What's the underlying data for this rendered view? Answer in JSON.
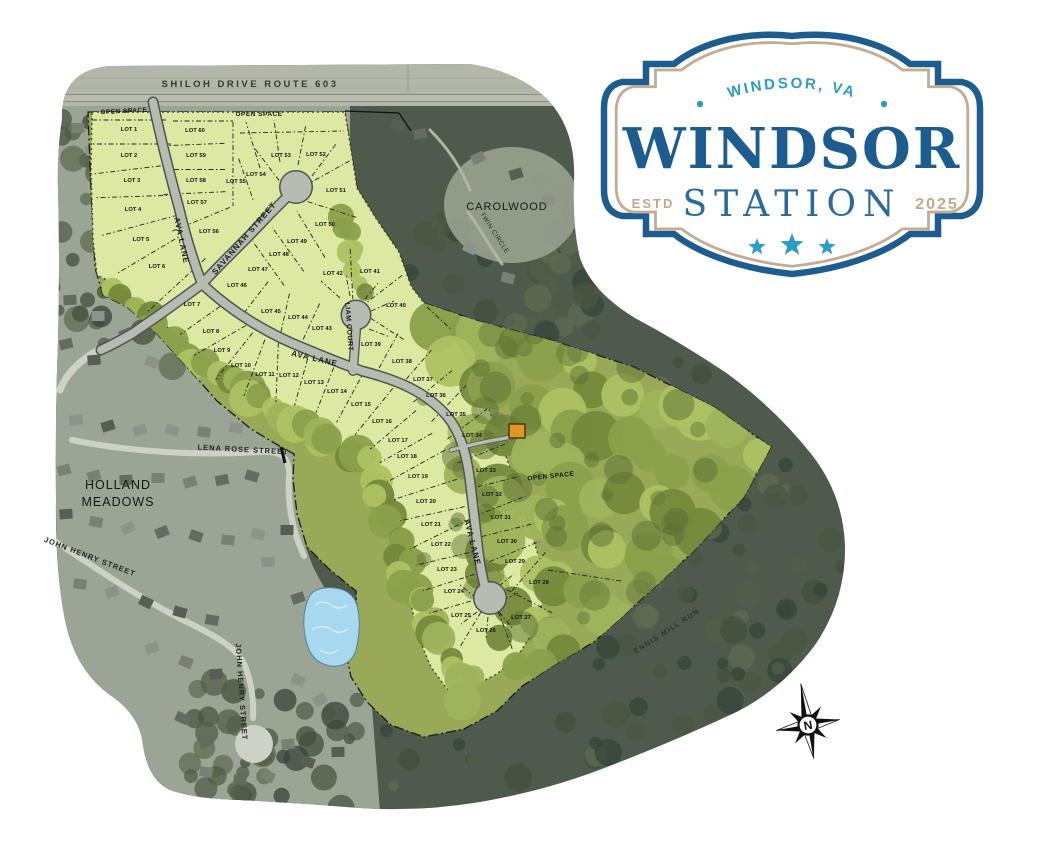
{
  "page": {
    "background": "#ffffff"
  },
  "logo": {
    "arc_text": "WINDSOR, VA",
    "name": "WINDSOR",
    "subname": "STATION",
    "estd": "ESTD",
    "year": "2025",
    "stars": 3,
    "colors": {
      "dark_blue": "#1d5c8e",
      "light_blue": "#2e9bc5",
      "mid_blue": "#2a6b9c",
      "tan": "#c3ac92"
    }
  },
  "compass": {
    "label": "N"
  },
  "map": {
    "lot_prefix": "LOT",
    "colors": {
      "plat_yellow": "#dde8a2",
      "plat_olive": "#99a957",
      "forest": "#4e5a4b",
      "pond": "#a8d8f0",
      "marker_orange": "#dd9722",
      "road_gray": "#b8bbb2"
    },
    "streets": [
      {
        "name": "SHILOH DRIVE ROUTE 603",
        "x": 250,
        "y": 87,
        "rotate": 0,
        "size": 9.5,
        "spacing": 2.5,
        "bold": true,
        "color": "#343931"
      },
      {
        "name": "AVA LANE",
        "x": 179,
        "y": 241,
        "rotate": 78,
        "size": 8,
        "spacing": 1,
        "bold": true,
        "color": "#1c1c1c"
      },
      {
        "name": "SAVANNAH STREET",
        "x": 246,
        "y": 240,
        "rotate": -49,
        "size": 8,
        "spacing": 1,
        "bold": true,
        "color": "#1c1c1c"
      },
      {
        "name": "AVA LANE",
        "x": 314,
        "y": 361,
        "rotate": 13,
        "size": 8,
        "spacing": 1,
        "bold": true,
        "color": "#1c1c1c"
      },
      {
        "name": "LIAM COURT",
        "x": 347,
        "y": 327,
        "rotate": 86,
        "size": 7,
        "spacing": 0.5,
        "bold": true,
        "color": "#1c1c1c"
      },
      {
        "name": "AVA LANE",
        "x": 470,
        "y": 543,
        "rotate": 76,
        "size": 8,
        "spacing": 1,
        "bold": true,
        "color": "#1c1c1c"
      },
      {
        "name": "LENA ROSE STREET",
        "x": 243,
        "y": 452,
        "rotate": 3,
        "size": 7.5,
        "spacing": 1,
        "bold": true,
        "color": "#23261f"
      },
      {
        "name": "JOHN HENRY STREET",
        "x": 89,
        "y": 559,
        "rotate": 21,
        "size": 7.5,
        "spacing": 1,
        "bold": true,
        "color": "#23261f"
      },
      {
        "name": "JOHN HENRY STREET",
        "x": 239,
        "y": 692,
        "rotate": 86,
        "size": 7.5,
        "spacing": 1,
        "bold": true,
        "color": "#23261f"
      },
      {
        "name": "TWIN CIRCLE",
        "x": 493,
        "y": 234,
        "rotate": 57,
        "size": 6.5,
        "spacing": 0.5,
        "bold": false,
        "color": "#2a2d27"
      },
      {
        "name": "ENNIS MILL RUN",
        "x": 668,
        "y": 633,
        "rotate": -33,
        "size": 7,
        "spacing": 1.5,
        "bold": false,
        "color": "#20241f"
      }
    ],
    "areas": [
      {
        "name": "OPEN SPACE",
        "x": 124,
        "y": 113,
        "rotate": -3,
        "size": 6.5,
        "spacing": 0.5,
        "bold": true,
        "color": "#161616"
      },
      {
        "name": "OPEN SPACE",
        "x": 259,
        "y": 116,
        "rotate": 0,
        "size": 6.5,
        "spacing": 0.5,
        "bold": true,
        "color": "#161616"
      },
      {
        "name": "OPEN SPACE",
        "x": 551,
        "y": 478,
        "rotate": -6,
        "size": 6.5,
        "spacing": 0.5,
        "bold": true,
        "color": "#161616"
      },
      {
        "name": "CAROLWOOD",
        "x": 507,
        "y": 210,
        "rotate": 0,
        "size": 11,
        "spacing": 1,
        "bold": false,
        "color": "#181b17"
      },
      {
        "name": "HOLLAND",
        "x": 118,
        "y": 489,
        "rotate": 0,
        "size": 12.5,
        "spacing": 1,
        "bold": false,
        "color": "#141613"
      },
      {
        "name": "MEADOWS",
        "x": 118,
        "y": 506,
        "rotate": 0,
        "size": 12.5,
        "spacing": 1,
        "bold": false,
        "color": "#141613"
      }
    ],
    "lots": [
      {
        "n": 1,
        "x": 129,
        "y": 131
      },
      {
        "n": 2,
        "x": 129,
        "y": 157
      },
      {
        "n": 3,
        "x": 132,
        "y": 182
      },
      {
        "n": 4,
        "x": 133,
        "y": 211
      },
      {
        "n": 5,
        "x": 141,
        "y": 241
      },
      {
        "n": 6,
        "x": 157,
        "y": 268
      },
      {
        "n": 7,
        "x": 192,
        "y": 306
      },
      {
        "n": 8,
        "x": 211,
        "y": 333
      },
      {
        "n": 9,
        "x": 222,
        "y": 352
      },
      {
        "n": 10,
        "x": 241,
        "y": 367
      },
      {
        "n": 11,
        "x": 265,
        "y": 376
      },
      {
        "n": 12,
        "x": 289,
        "y": 377
      },
      {
        "n": 13,
        "x": 314,
        "y": 384
      },
      {
        "n": 14,
        "x": 337,
        "y": 393
      },
      {
        "n": 15,
        "x": 361,
        "y": 406
      },
      {
        "n": 16,
        "x": 382,
        "y": 423
      },
      {
        "n": 17,
        "x": 398,
        "y": 442
      },
      {
        "n": 18,
        "x": 407,
        "y": 458
      },
      {
        "n": 19,
        "x": 418,
        "y": 478
      },
      {
        "n": 20,
        "x": 426,
        "y": 503
      },
      {
        "n": 21,
        "x": 431,
        "y": 526
      },
      {
        "n": 22,
        "x": 441,
        "y": 546
      },
      {
        "n": 23,
        "x": 447,
        "y": 571
      },
      {
        "n": 24,
        "x": 454,
        "y": 593
      },
      {
        "n": 25,
        "x": 461,
        "y": 617
      },
      {
        "n": 26,
        "x": 486,
        "y": 632
      },
      {
        "n": 27,
        "x": 521,
        "y": 619
      },
      {
        "n": 28,
        "x": 539,
        "y": 584
      },
      {
        "n": 29,
        "x": 515,
        "y": 563
      },
      {
        "n": 30,
        "x": 507,
        "y": 543
      },
      {
        "n": 31,
        "x": 501,
        "y": 519
      },
      {
        "n": 32,
        "x": 492,
        "y": 496
      },
      {
        "n": 33,
        "x": 486,
        "y": 472
      },
      {
        "n": 34,
        "x": 472,
        "y": 437
      },
      {
        "n": 35,
        "x": 456,
        "y": 416
      },
      {
        "n": 36,
        "x": 436,
        "y": 397
      },
      {
        "n": 37,
        "x": 423,
        "y": 381
      },
      {
        "n": 38,
        "x": 402,
        "y": 363
      },
      {
        "n": 39,
        "x": 371,
        "y": 346
      },
      {
        "n": 40,
        "x": 396,
        "y": 307
      },
      {
        "n": 41,
        "x": 370,
        "y": 273
      },
      {
        "n": 42,
        "x": 333,
        "y": 275
      },
      {
        "n": 43,
        "x": 322,
        "y": 330
      },
      {
        "n": 44,
        "x": 298,
        "y": 319
      },
      {
        "n": 45,
        "x": 271,
        "y": 313
      },
      {
        "n": 46,
        "x": 237,
        "y": 287
      },
      {
        "n": 47,
        "x": 258,
        "y": 271
      },
      {
        "n": 48,
        "x": 279,
        "y": 256
      },
      {
        "n": 49,
        "x": 297,
        "y": 243
      },
      {
        "n": 50,
        "x": 325,
        "y": 226
      },
      {
        "n": 51,
        "x": 336,
        "y": 192
      },
      {
        "n": 52,
        "x": 316,
        "y": 156
      },
      {
        "n": 53,
        "x": 281,
        "y": 157
      },
      {
        "n": 54,
        "x": 256,
        "y": 176
      },
      {
        "n": 55,
        "x": 236,
        "y": 183
      },
      {
        "n": 56,
        "x": 209,
        "y": 233
      },
      {
        "n": 57,
        "x": 197,
        "y": 204
      },
      {
        "n": 58,
        "x": 196,
        "y": 182
      },
      {
        "n": 59,
        "x": 196,
        "y": 157
      },
      {
        "n": 60,
        "x": 195,
        "y": 132
      }
    ]
  }
}
